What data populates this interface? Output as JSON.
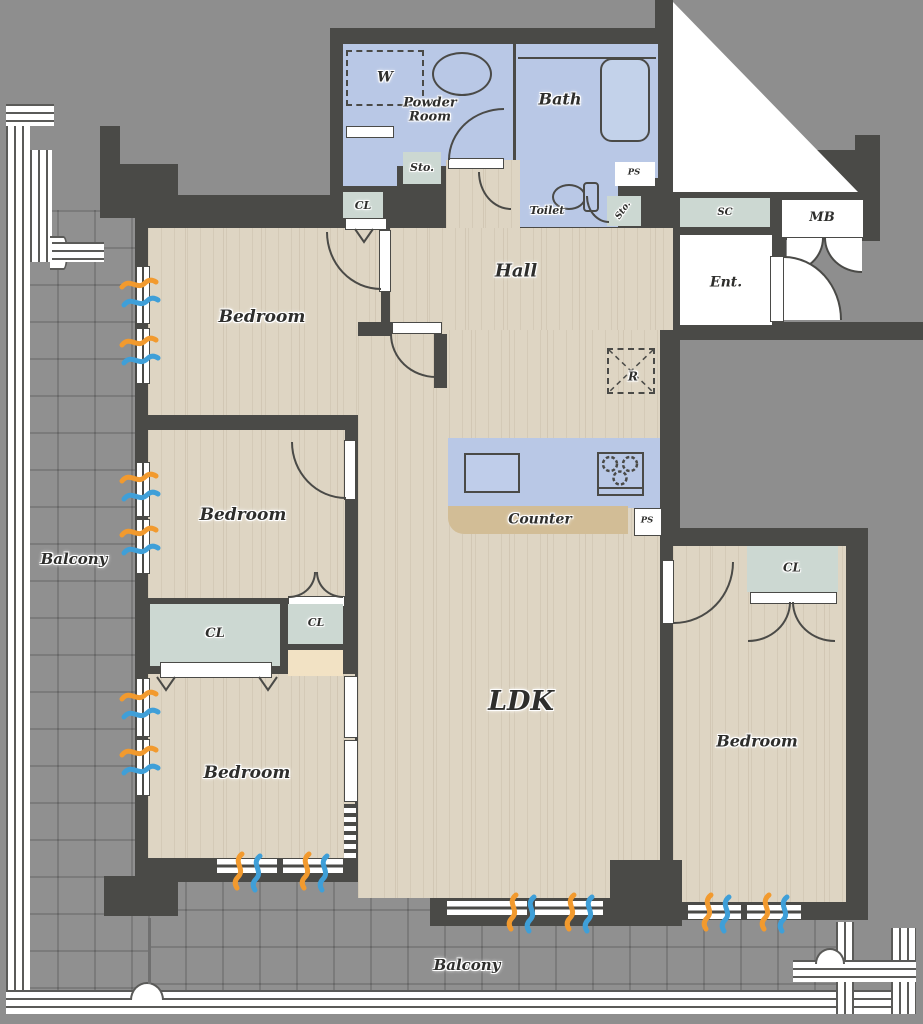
{
  "plan_type": "apartment-floor-plan",
  "labels": {
    "w": "W",
    "powder_room": "Powder\nRoom",
    "bath": "Bath",
    "sto": "Sto.",
    "cl": "CL",
    "toilet": "Toilet",
    "ps": "PS",
    "sc": "SC",
    "mb": "MB",
    "ent": "Ent.",
    "hall": "Hall",
    "fridge": "R",
    "bedroom": "Bedroom",
    "counter": "Counter",
    "ldk": "LDK",
    "balcony": "Balcony"
  },
  "colors": {
    "wall": "#4a4a47",
    "exterior": "#8e8e8e",
    "floor_wood": "#ded5c3",
    "wet_area": "#b9c8e6",
    "closet": "#ccd8d2",
    "counter_top": "#d2bd96",
    "accent_beige": "#f2e2c4",
    "balcony_tile": "#909090",
    "airflow_warm": "#f29a2e",
    "airflow_cool": "#3f9fd8"
  }
}
